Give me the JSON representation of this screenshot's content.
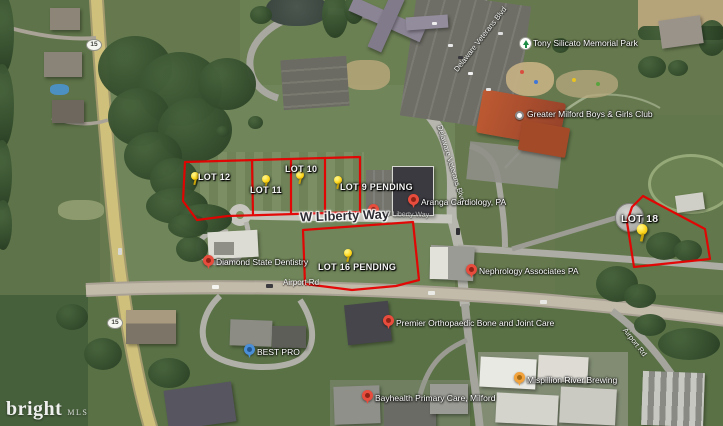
{
  "watermark": {
    "brand": "bright",
    "suffix": "MLS"
  },
  "shield": {
    "route": "15"
  },
  "roads": {
    "airport": "Airport Rd",
    "veterans": "Delaware Veterans Blvd",
    "liberty": "W Liberty Way"
  },
  "lots": [
    {
      "label": "LOT 12"
    },
    {
      "label": "LOT 11"
    },
    {
      "label": "LOT 10"
    },
    {
      "label": "LOT 9 PENDING"
    },
    {
      "label": "LOT 16 PENDING"
    },
    {
      "label": "LOT 18"
    }
  ],
  "places": [
    {
      "name": "Tony Silicato Memorial Park",
      "marker": "park-icon"
    },
    {
      "name": "Greater Milford Boys & Girls Club",
      "marker": "poi-dot"
    },
    {
      "name": "Aranga Cardiology, PA",
      "marker": "red-pin"
    },
    {
      "name": "Diamond State Dentistry",
      "marker": "red-pin"
    },
    {
      "name": "Nephrology Associates PA",
      "marker": "red-pin"
    },
    {
      "name": "Premier Orthopaedic Bone and Joint Care",
      "marker": "red-pin"
    },
    {
      "name": "BEST PRO",
      "marker": "blue-pin"
    },
    {
      "name": "Mispillion River Brewing",
      "marker": "orange-pin"
    },
    {
      "name": "Bayhealth Primary Care, Milford",
      "marker": "red-pin"
    }
  ],
  "colors": {
    "lot_outline": "#e60000",
    "pushpin": "#ffd71e",
    "pin_red": "#e84c3d",
    "pin_blue": "#4a8fd8",
    "pin_orange": "#f2a33c",
    "park_green": "#1d8c46"
  }
}
